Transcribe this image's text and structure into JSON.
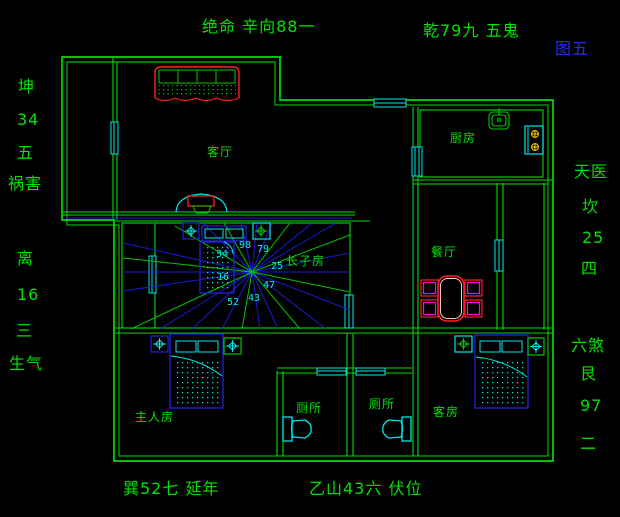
{
  "figure_label": "图五",
  "annotations": {
    "top_left": "绝命 辛向88一",
    "top_right": "乾79九 五鬼",
    "left_upper": [
      "坤",
      "34",
      "五",
      "祸害"
    ],
    "left_lower": [
      "离",
      "16",
      "三",
      "生气"
    ],
    "right_upper": [
      "天医",
      "坎",
      "25",
      "四"
    ],
    "right_lower": [
      "六煞",
      "艮",
      "97",
      "二"
    ],
    "bottom_left": "巽52七 延年",
    "bottom_right": "乙山43六 伏位"
  },
  "rooms": {
    "living_room": "客厅",
    "kitchen": "厨房",
    "dining_room": "餐厅",
    "eldest_son_room": "长子房",
    "master_bedroom": "主人房",
    "toilet_left": "厕所",
    "toilet_right": "厕所",
    "guest_room": "客房"
  },
  "compass_numbers": [
    "98",
    "79",
    "25",
    "47",
    "43",
    "52",
    "16",
    "34"
  ],
  "colors": {
    "background": "#000000",
    "wall_green": "#00DD00",
    "accent_red": "#FF1F1F",
    "fixture_cyan": "#00E8E8",
    "compass_blue": "#1A1AD8",
    "figure_label_blue": "#2B2BEF",
    "burner_yellow": "#FFD700",
    "chair_magenta": "#FF00FF"
  }
}
